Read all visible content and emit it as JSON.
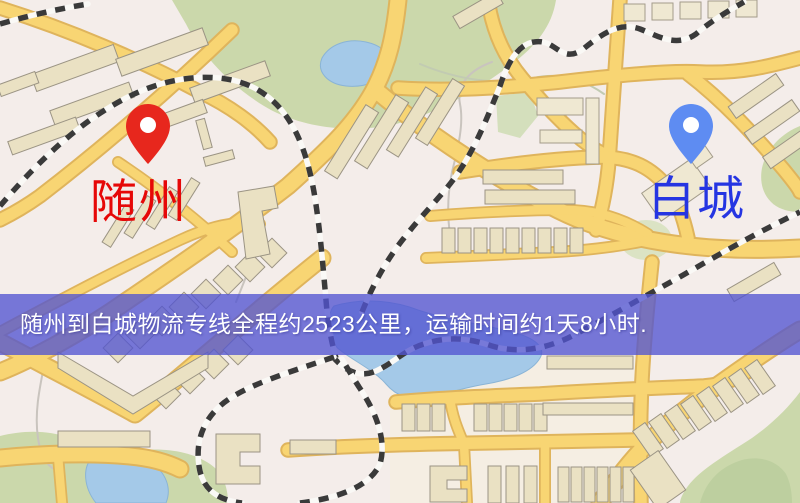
{
  "markers": {
    "origin": {
      "label": "随州",
      "icon": "red-pin-icon",
      "pin_color": "#e7271d",
      "label_color": "#e60808"
    },
    "destination": {
      "label": "白城",
      "icon": "blue-pin-icon",
      "pin_color": "#5e8cf2",
      "label_color": "#2535e2"
    }
  },
  "banner": {
    "text": "随州到白城物流专线全程约2523公里，运输时间约1天8小时.",
    "background_color": "#5254d1",
    "text_color": "#ffffff",
    "distance_km": "2523",
    "transit_time": "1天8小时"
  },
  "map_colors": {
    "background": "#f4edea",
    "road_fill": "#f8d573",
    "road_casing": "#dfb45c",
    "green_area": "#cbd8ab",
    "water": "#a4c9e8",
    "building": "#eae1c3",
    "railway": "#3a3a3a"
  }
}
